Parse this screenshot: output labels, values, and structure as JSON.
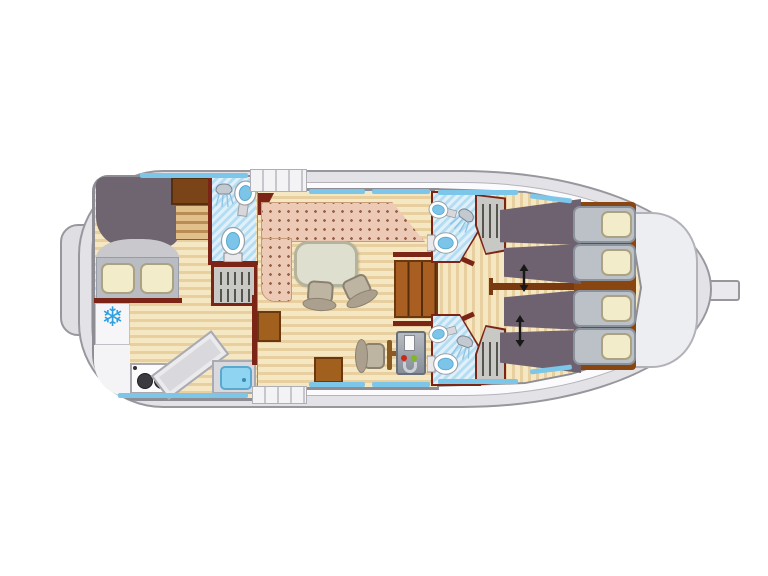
{
  "page": {
    "background": "#ffffff"
  },
  "diagram": {
    "type": "floor-plan",
    "subject": "canal-boat interior deck plan, top-down view",
    "orientation": {
      "bow": "right",
      "stern": "left"
    }
  },
  "icons": {
    "snowflake": {
      "name": "snowflake-icon",
      "glyph": "❄",
      "meaning": "fridge",
      "color": "#2e9fe0"
    },
    "stove": {
      "name": "stove-icon",
      "burners": 2
    },
    "double_arrow": {
      "name": "double-arrow-icon",
      "count": 2,
      "meaning": "sliding berths"
    },
    "shower_count": 3,
    "toilet_count": 3,
    "washbasin_count": 3,
    "galley_sink_count": 1
  },
  "areas": [
    {
      "id": "stern-platform",
      "label": "stern platform"
    },
    {
      "id": "stern-cabin",
      "label": "aft cabin with double berth"
    },
    {
      "id": "stern-bathroom",
      "label": "aft bathroom: shower, washbasin, toilet"
    },
    {
      "id": "galley",
      "label": "galley: 2-burner stove, worktop, sink"
    },
    {
      "id": "saloon",
      "label": "saloon: L-sofa, table, two chairs"
    },
    {
      "id": "helm",
      "label": "inner steering console with seat"
    },
    {
      "id": "companionway",
      "label": "steps to bow cabins"
    },
    {
      "id": "bow-bathroom-port",
      "label": "bow bathroom port"
    },
    {
      "id": "bow-bathroom-starboard",
      "label": "bow bathroom starboard"
    },
    {
      "id": "bow-cabins",
      "label": "two bow cabins, four single berths"
    },
    {
      "id": "bow-deck",
      "label": "foredeck"
    }
  ],
  "counts": {
    "single_berths": 4,
    "double_berths": 1,
    "pillows_visible": 6,
    "window_bands": 10,
    "deck_step_flights": 2,
    "wardrobes": 3,
    "dining_chairs": 2
  },
  "colors": {
    "hull": "#e3e3e7",
    "hull_line": "#97979d",
    "deck": "#fbfbfd",
    "floor_light": "#f5e7c1",
    "floor_dark": "#e8cf9f",
    "interior_wall": "#7c2416",
    "wood": "#a95f22",
    "sofa": "#eccab6",
    "sofa_dot": "#9a6248",
    "blanket": "#6e6270",
    "bed_head": "#bcc1c8",
    "pillow": "#f3ecca",
    "window": "#7cc6e9",
    "bath_floor": "#cfe9f7",
    "fixture_blue": "#7cc5e8",
    "table": "#dfdfd0",
    "chair": "#beb4a2",
    "console": "#9aa0a8",
    "indicator_red": "#cc2818",
    "indicator_green": "#80b820",
    "snowflake": "#2e9fe0"
  }
}
